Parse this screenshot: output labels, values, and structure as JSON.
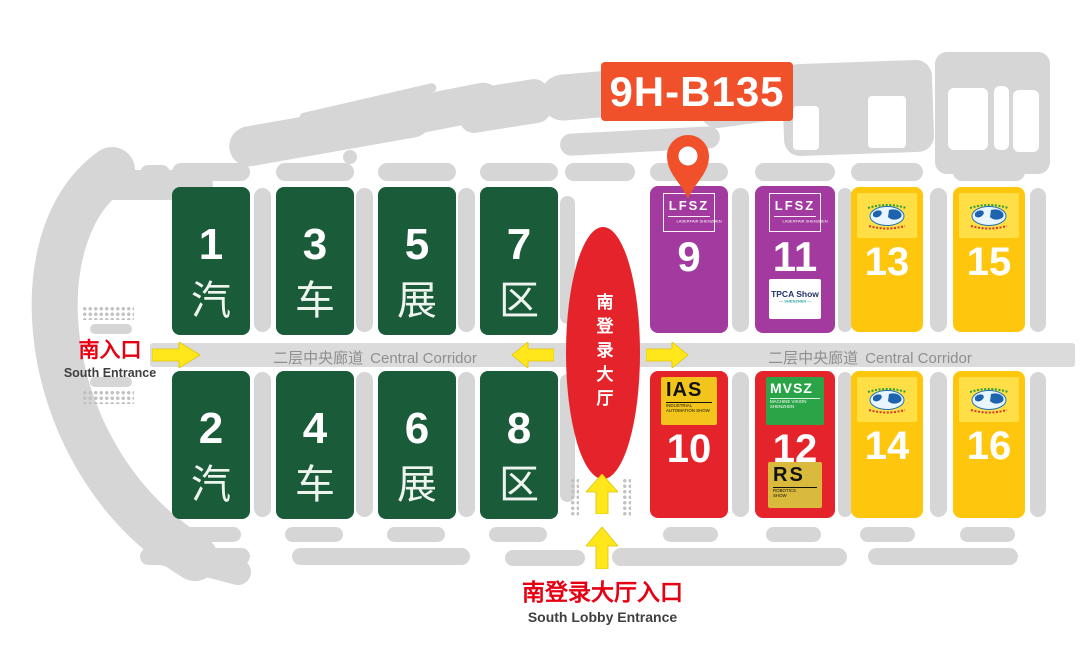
{
  "booth_badge": {
    "label": "9H-B135",
    "color": "#f0512a"
  },
  "corridor": {
    "zh": "二层中央廊道",
    "en": "Central Corridor"
  },
  "lobby": {
    "label_zh": "南登录大厅"
  },
  "south_entrance": {
    "zh": "南入口",
    "en": "South Entrance"
  },
  "south_lobby_entrance": {
    "zh": "南登录大厅入口",
    "en": "South Lobby Entrance"
  },
  "halls": [
    {
      "number": "1",
      "cjk": "汽",
      "color": "#1a5b3a"
    },
    {
      "number": "2",
      "cjk": "汽",
      "color": "#1a5b3a"
    },
    {
      "number": "3",
      "cjk": "车",
      "color": "#1a5b3a"
    },
    {
      "number": "4",
      "cjk": "车",
      "color": "#1a5b3a"
    },
    {
      "number": "5",
      "cjk": "展",
      "color": "#1a5b3a"
    },
    {
      "number": "6",
      "cjk": "展",
      "color": "#1a5b3a"
    },
    {
      "number": "7",
      "cjk": "区",
      "color": "#1a5b3a"
    },
    {
      "number": "8",
      "cjk": "区",
      "color": "#1a5b3a"
    },
    {
      "number": "9",
      "color": "#a23aa0"
    },
    {
      "number": "10",
      "color": "#e5232b"
    },
    {
      "number": "11",
      "color": "#a23aa0"
    },
    {
      "number": "12",
      "color": "#e5232b"
    },
    {
      "number": "13",
      "color": "#ffc60e"
    },
    {
      "number": "14",
      "color": "#ffc60e"
    },
    {
      "number": "15",
      "color": "#ffc60e"
    },
    {
      "number": "16",
      "color": "#ffc60e"
    }
  ],
  "logos": {
    "lfsz": {
      "title": "LFSZ",
      "subtitle": "LASERFAIR SHENZHEN"
    },
    "tpca": {
      "title": "TPCA Show",
      "subtitle": "SHENZHEN"
    },
    "ias": {
      "title": "IAS",
      "subtitle": "INDUSTRIAL AUTOMATION SHOW"
    },
    "mvsz": {
      "title": "MVSZ",
      "subtitle": "MACHINE VISION SHENZHEN"
    },
    "rs": {
      "title": "RS",
      "subtitle": "ROBOTICS SHOW"
    }
  },
  "arrow_color": "#ffe71c"
}
